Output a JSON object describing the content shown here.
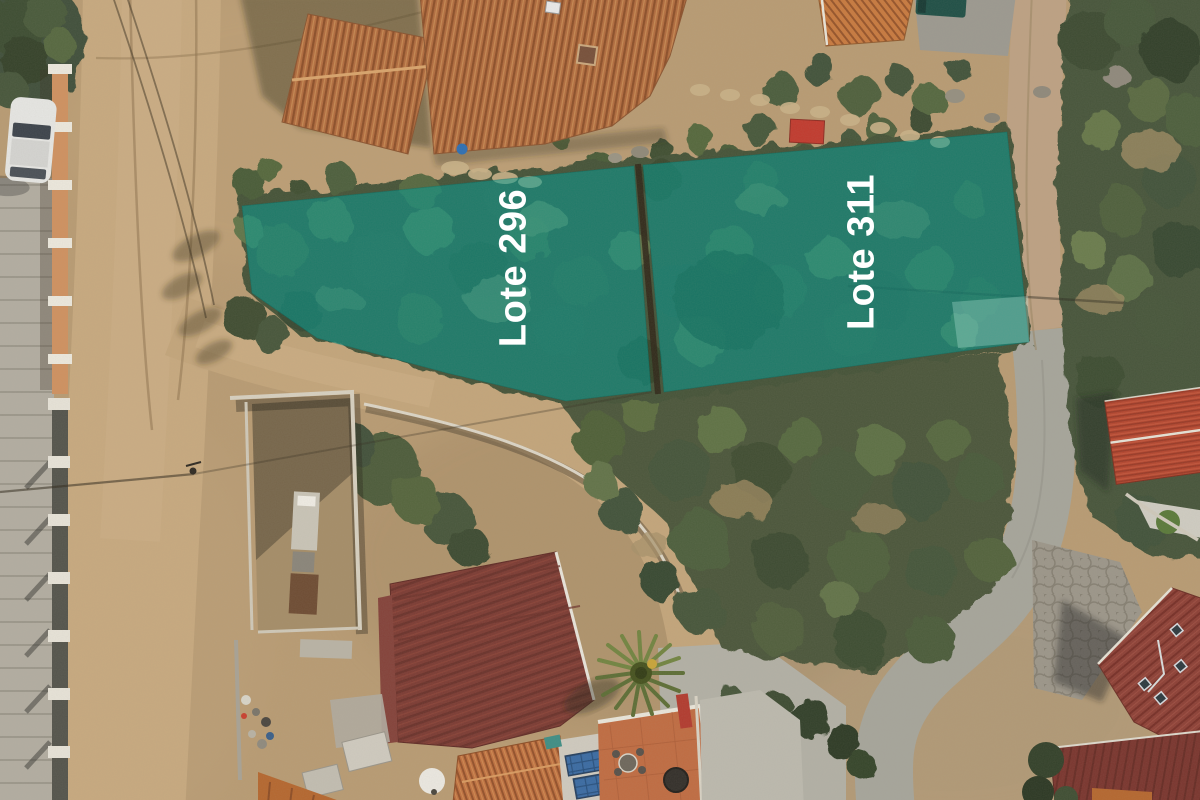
{
  "scene": {
    "overlay_fill": "rgba(0,155,145,0.55)",
    "overlay_fill_light": "rgba(195,242,228,0.30)",
    "label_color": "#ffffff"
  },
  "lots": [
    {
      "id": "lote-296",
      "label": "Lote 296"
    },
    {
      "id": "lote-311",
      "label": "Lote 311"
    }
  ]
}
